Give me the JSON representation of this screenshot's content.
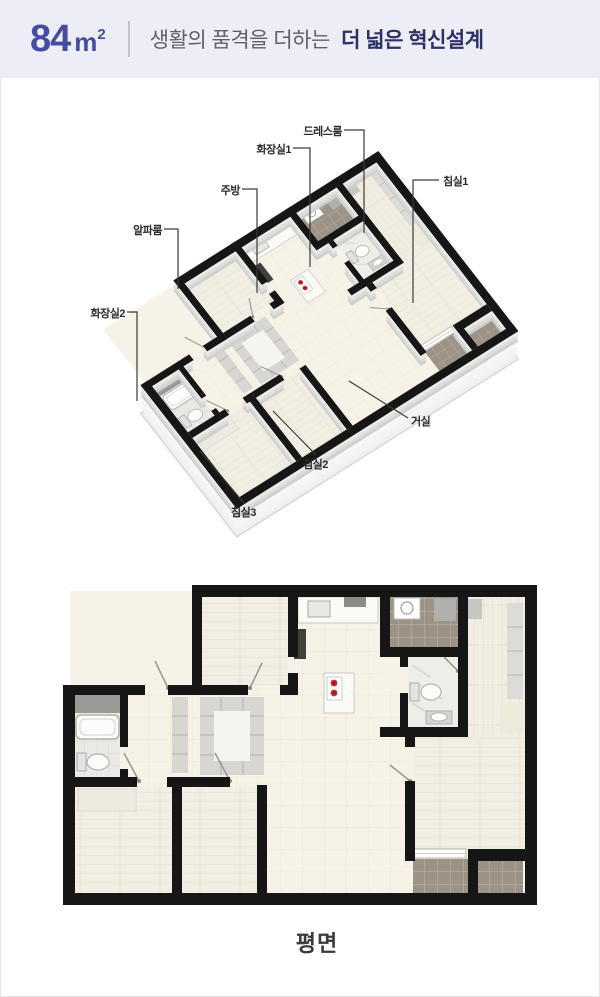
{
  "header": {
    "area_value": "84",
    "area_unit": "m",
    "area_exponent": "2",
    "tagline_regular": "생활의 품격을 더하는",
    "tagline_bold": "더 넓은 혁신설계"
  },
  "iso_plan": {
    "labels": [
      {
        "id": "dressroom",
        "text": "드레스룸"
      },
      {
        "id": "bathroom1",
        "text": "화장실1"
      },
      {
        "id": "kitchen",
        "text": "주방"
      },
      {
        "id": "bedroom1",
        "text": "침실1"
      },
      {
        "id": "alpharoom",
        "text": "알파룸"
      },
      {
        "id": "bathroom2",
        "text": "화장실2"
      },
      {
        "id": "living",
        "text": "거실"
      },
      {
        "id": "bedroom2",
        "text": "침실2"
      },
      {
        "id": "bedroom3",
        "text": "침실3"
      }
    ]
  },
  "floor_plan": {
    "caption": "평면"
  },
  "colors": {
    "header_bg": "#edeef5",
    "accent_indigo": "#454da0",
    "tagline_navy": "#2c3166",
    "wall_black": "#161616",
    "floor_cream": "#f7f2e7",
    "balcony_brown": "#9c9386",
    "burner_red": "#c62828"
  }
}
